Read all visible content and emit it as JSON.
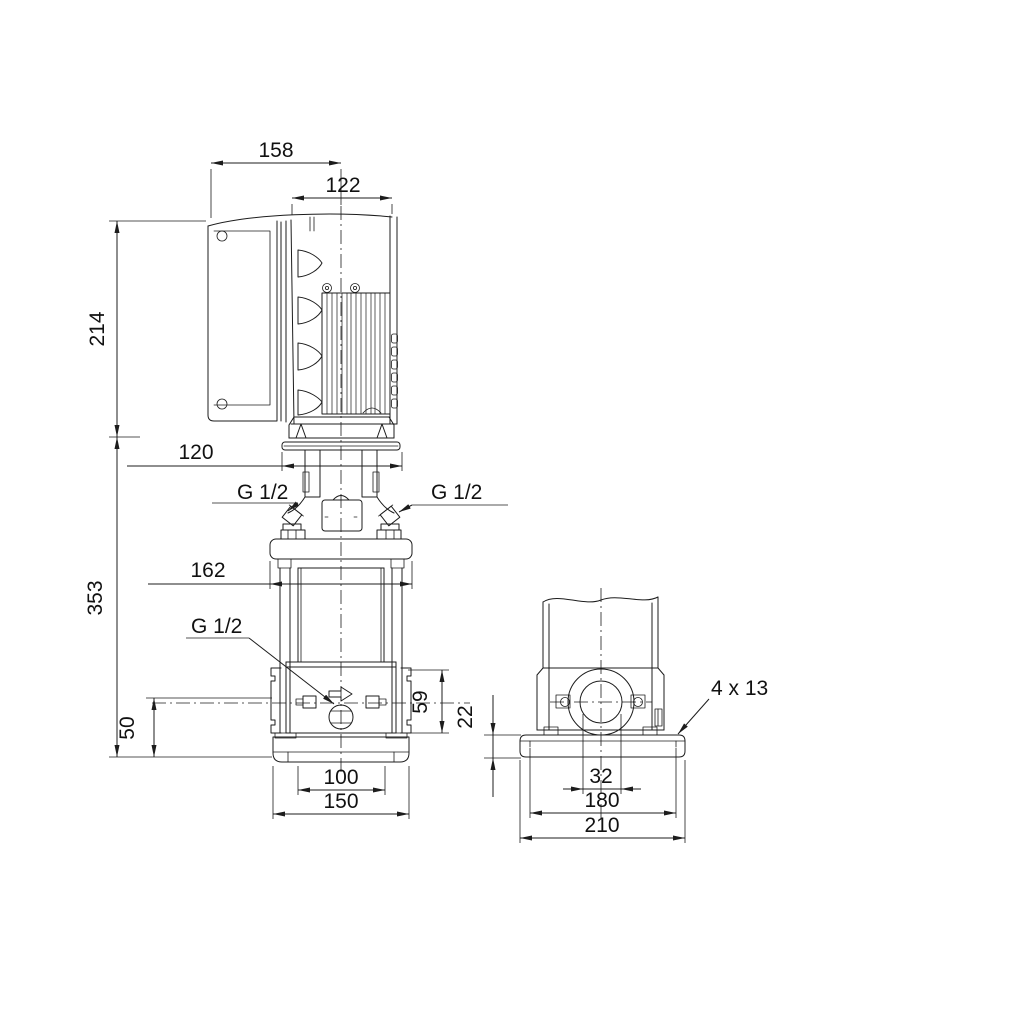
{
  "colors": {
    "line": "#1c1c1c",
    "background": "#ffffff"
  },
  "front_view": {
    "dim_control_box_width": "158",
    "dim_motor_width": "122",
    "dim_motor_height": "214",
    "dim_coupling_width": "120",
    "dim_head_flange_width": "162",
    "dim_pump_height": "353",
    "dim_port_center_height": "50",
    "dim_port_flange_height": "59",
    "dim_base_slot_width": "100",
    "dim_base_width": "150",
    "label_gauge_port_left": "G 1/2",
    "label_gauge_port_right": "G 1/2",
    "label_drain_port": "G 1/2"
  },
  "side_view": {
    "dim_base_plate_thickness": "22",
    "dim_port_bore": "32",
    "dim_bolt_hole_spacing": "180",
    "dim_base_depth": "210",
    "label_mounting_holes": "4 x 13"
  }
}
